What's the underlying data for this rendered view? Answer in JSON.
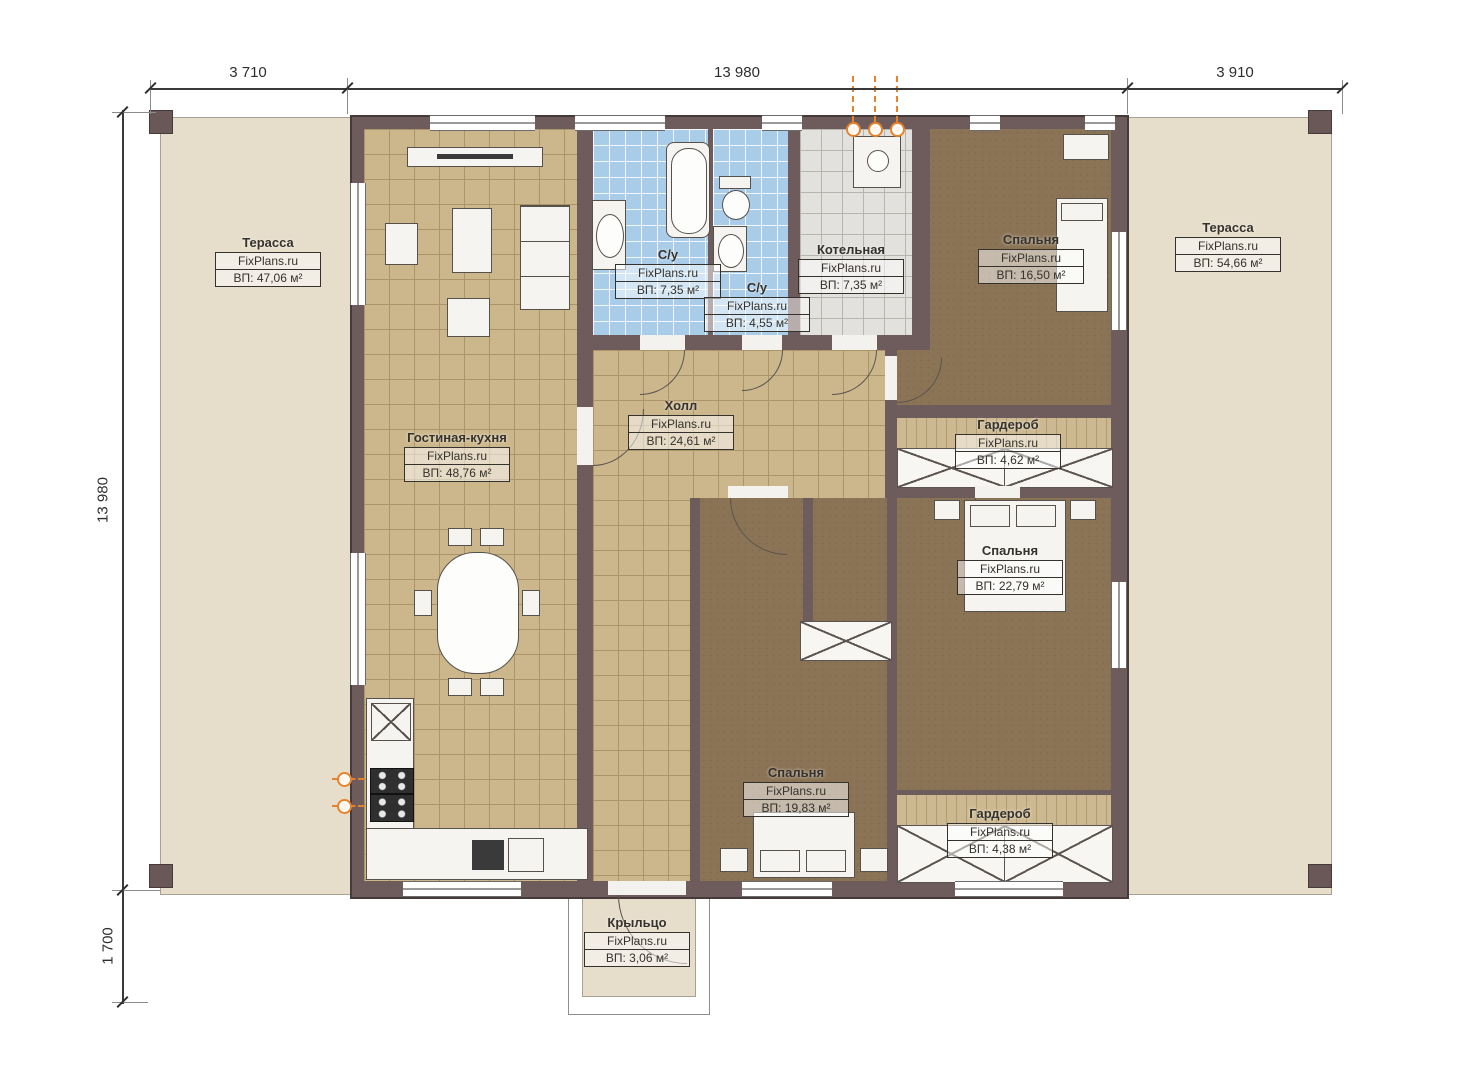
{
  "watermark": "FixPlans.ru",
  "dimensions": {
    "top": [
      "3 710",
      "13 980",
      "3 910"
    ],
    "left": [
      "13 980",
      "1 700"
    ]
  },
  "rooms": [
    {
      "id": "terrace-left",
      "name": "Терасса",
      "area": "ВП: 47,06 м²"
    },
    {
      "id": "living-kitchen",
      "name": "Гостиная-кухня",
      "area": "ВП: 48,76 м²"
    },
    {
      "id": "bath-1",
      "name": "С/у",
      "area": "ВП: 7,35 м²"
    },
    {
      "id": "bath-2",
      "name": "С/у",
      "area": "ВП: 4,55 м²"
    },
    {
      "id": "boiler",
      "name": "Котельная",
      "area": "ВП: 7,35 м²"
    },
    {
      "id": "bedroom-1",
      "name": "Спальня",
      "area": "ВП: 16,50 м²"
    },
    {
      "id": "terrace-right",
      "name": "Терасса",
      "area": "ВП: 54,66 м²"
    },
    {
      "id": "hall",
      "name": "Холл",
      "area": "ВП: 24,61 м²"
    },
    {
      "id": "wardrobe-1",
      "name": "Гардероб",
      "area": "ВП: 4,62 м²"
    },
    {
      "id": "bedroom-2",
      "name": "Спальня",
      "area": "ВП: 22,79 м²"
    },
    {
      "id": "bedroom-3",
      "name": "Спальня",
      "area": "ВП: 19,83 м²"
    },
    {
      "id": "wardrobe-2",
      "name": "Гардероб",
      "area": "ВП: 4,38 м²"
    },
    {
      "id": "porch",
      "name": "Крыльцо",
      "area": "ВП: 3,06 м²"
    }
  ],
  "colors": {
    "wall": "#6e5b5b",
    "terrace": "#e6ddca",
    "tile_tan": "#ccb78c",
    "tile_blue": "#a9cce9",
    "tile_gray": "#e2e1de",
    "floor_brown": "#8b7456",
    "utility_orange": "#e8822a"
  }
}
